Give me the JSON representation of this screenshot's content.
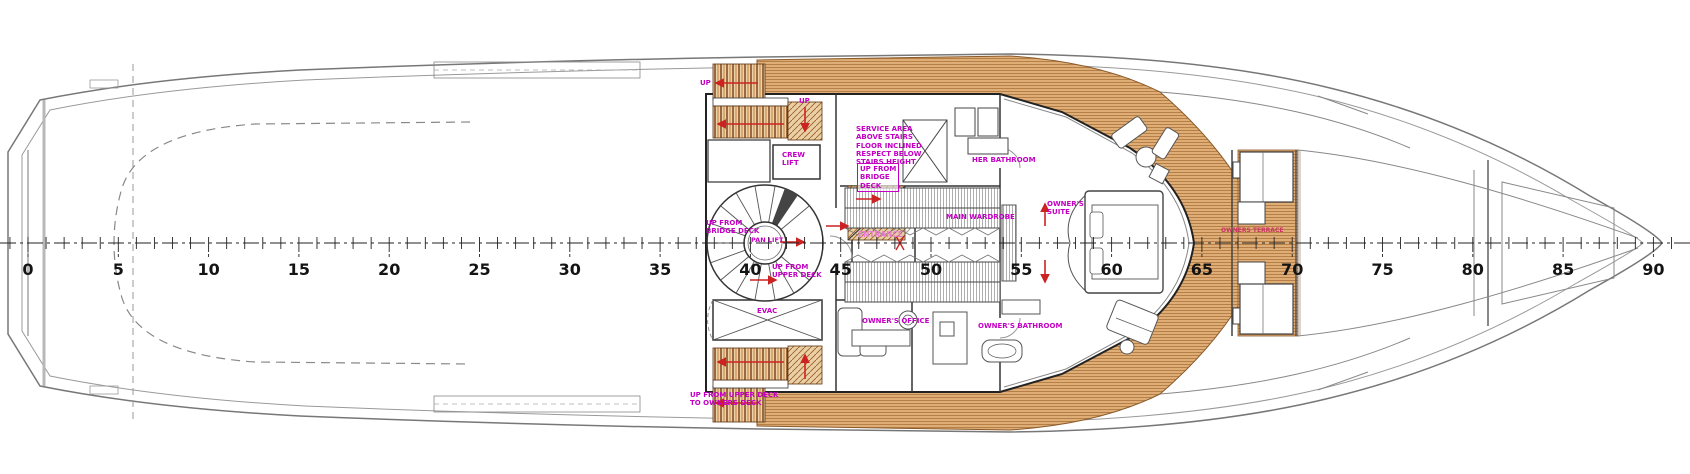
{
  "colors": {
    "label_magenta": "#c400c4",
    "label_pink": "#e879d8",
    "label_redpink": "#cc3366",
    "arrow_red": "#cc2222",
    "wood": "#dfae77",
    "wood_line": "#9c5f28",
    "wall": "#222222",
    "hull": "#888888"
  },
  "labels": {
    "up_top": "UP",
    "up_winder": "UP",
    "service_note": [
      "SERVICE AREA",
      "ABOVE STAIRS",
      "FLOOR INCLINED",
      "RESPECT BELOW",
      "STAIRS HEIGHT"
    ],
    "up_from_bridge_boxed": [
      "UP FROM",
      "BRIDGE",
      "DECK"
    ],
    "crew_lift": [
      "CREW",
      "LIFT"
    ],
    "up_from_bridge_spiral": [
      "UP FROM",
      "BRIDGE DECK"
    ],
    "pan_lift": "PAN LIFT",
    "up_from_upper_spiral": [
      "UP FROM",
      "UPPER DECK"
    ],
    "entrance": "ENTRANCE",
    "her_bathroom": "HER BATHROOM",
    "main_wardrobe": "MAIN WARDROBE",
    "owners_suite": [
      "OWNER'S",
      "SUITE"
    ],
    "owners_office": "OWNER'S OFFICE",
    "owners_bathroom": "OWNER'S BATHROOM",
    "evac": "EVAC",
    "owners_terrace": "OWNERS TERRACE",
    "up_bottom": [
      "UP FROM UPPER DECK",
      "TO OWNERS DECK"
    ]
  },
  "scale": {
    "frames": [
      0,
      5,
      10,
      15,
      20,
      25,
      30,
      35,
      40,
      45,
      50,
      55,
      60,
      65,
      70,
      75,
      80,
      85,
      90
    ]
  }
}
